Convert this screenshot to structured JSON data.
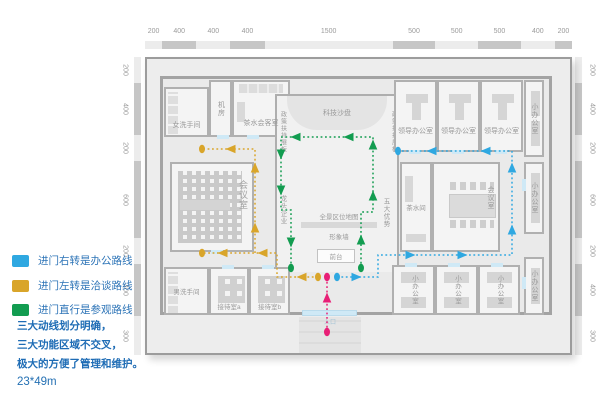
{
  "legend": {
    "items": [
      {
        "name": "office-route",
        "color": "#2FA8E1",
        "label": "进门右转是办公路线"
      },
      {
        "name": "negotiation-route",
        "color": "#D9A52A",
        "label": "进门左转是洽谈路线"
      },
      {
        "name": "tour-route",
        "color": "#129C50",
        "label": "进门直行是参观路线"
      }
    ]
  },
  "notes": {
    "line1": "三大动线划分明确，",
    "line2": "三大功能区域不交叉，",
    "line3": "极大的方便了管理和维护。",
    "size": "23*49m"
  },
  "dimensions": {
    "top": [
      "200",
      "400",
      "400",
      "400",
      "1500",
      "500",
      "500",
      "500",
      "400",
      "200"
    ],
    "left": [
      "200",
      "400",
      "200",
      "600",
      "200",
      "400",
      "300"
    ],
    "right": [
      "200",
      "400",
      "200",
      "600",
      "200",
      "400",
      "300"
    ]
  },
  "rooms": {
    "womens_restroom": "女洗手间",
    "machine_room": "机房",
    "tea_reception": "茶水会客室",
    "tech_sandbox": "科技沙盘",
    "policy_board": "政策扶持展板",
    "leader_office": "领导办公室",
    "small_office": "小办公室",
    "tea_room": "茶水间",
    "conference_room": "会议室",
    "meeting_room": "会议室",
    "leading_enterprises": "龙头企业",
    "five_advantages": "五大优势",
    "panorama_map": "全景区位地图",
    "image_wall": "形象墙",
    "front_desk": "前台",
    "entrance": "入口",
    "mens_restroom": "男洗手间",
    "reception_a": "接待室a",
    "reception_b": "接待室b"
  },
  "routes": [
    {
      "name": "negotiation-route",
      "color": "#D9A52A",
      "segments": [
        [
          [
            318,
            277
          ],
          [
            277,
            277
          ],
          [
            277,
            253
          ],
          [
            202,
            253
          ]
        ],
        [
          [
            255,
            253
          ],
          [
            255,
            149
          ],
          [
            202,
            149
          ]
        ]
      ],
      "dots": [
        [
          318,
          277
        ],
        [
          202,
          253
        ],
        [
          202,
          149
        ]
      ],
      "arrows": [
        {
          "x": 302,
          "y": 277,
          "d": "l"
        },
        {
          "x": 263,
          "y": 253,
          "d": "l"
        },
        {
          "x": 223,
          "y": 253,
          "d": "l"
        },
        {
          "x": 255,
          "y": 228,
          "d": "u"
        },
        {
          "x": 255,
          "y": 168,
          "d": "u"
        },
        {
          "x": 231,
          "y": 149,
          "d": "l"
        }
      ]
    },
    {
      "name": "tour-route",
      "color": "#129C50",
      "segments": [
        [
          [
            361,
            268
          ],
          [
            361,
            212
          ],
          [
            373,
            212
          ],
          [
            373,
            137
          ],
          [
            281,
            137
          ],
          [
            281,
            210
          ],
          [
            291,
            210
          ],
          [
            291,
            268
          ]
        ]
      ],
      "dots": [
        [
          361,
          268
        ],
        [
          291,
          268
        ]
      ],
      "arrows": [
        {
          "x": 361,
          "y": 240,
          "d": "u"
        },
        {
          "x": 373,
          "y": 196,
          "d": "u"
        },
        {
          "x": 373,
          "y": 145,
          "d": "u"
        },
        {
          "x": 349,
          "y": 137,
          "d": "l"
        },
        {
          "x": 296,
          "y": 137,
          "d": "l"
        },
        {
          "x": 281,
          "y": 154,
          "d": "dn"
        },
        {
          "x": 281,
          "y": 190,
          "d": "dn"
        },
        {
          "x": 291,
          "y": 242,
          "d": "dn"
        }
      ]
    },
    {
      "name": "office-route",
      "color": "#2FA8E1",
      "segments": [
        [
          [
            337,
            277
          ],
          [
            378,
            277
          ],
          [
            378,
            255
          ],
          [
            512,
            255
          ],
          [
            512,
            151
          ],
          [
            398,
            151
          ]
        ]
      ],
      "dots": [
        [
          337,
          277
        ],
        [
          398,
          151
        ]
      ],
      "arrows": [
        {
          "x": 356,
          "y": 277,
          "d": "r"
        },
        {
          "x": 410,
          "y": 255,
          "d": "r"
        },
        {
          "x": 462,
          "y": 255,
          "d": "r"
        },
        {
          "x": 512,
          "y": 230,
          "d": "u"
        },
        {
          "x": 512,
          "y": 168,
          "d": "u"
        },
        {
          "x": 486,
          "y": 151,
          "d": "l"
        },
        {
          "x": 432,
          "y": 151,
          "d": "l"
        }
      ]
    },
    {
      "name": "entrance-route",
      "color": "#E81F76",
      "segments": [
        [
          [
            327,
            332
          ],
          [
            327,
            277
          ]
        ]
      ],
      "dots": [
        [
          327,
          332
        ],
        [
          327,
          277
        ]
      ],
      "arrows": [
        {
          "x": 327,
          "y": 298,
          "d": "u"
        }
      ]
    }
  ]
}
